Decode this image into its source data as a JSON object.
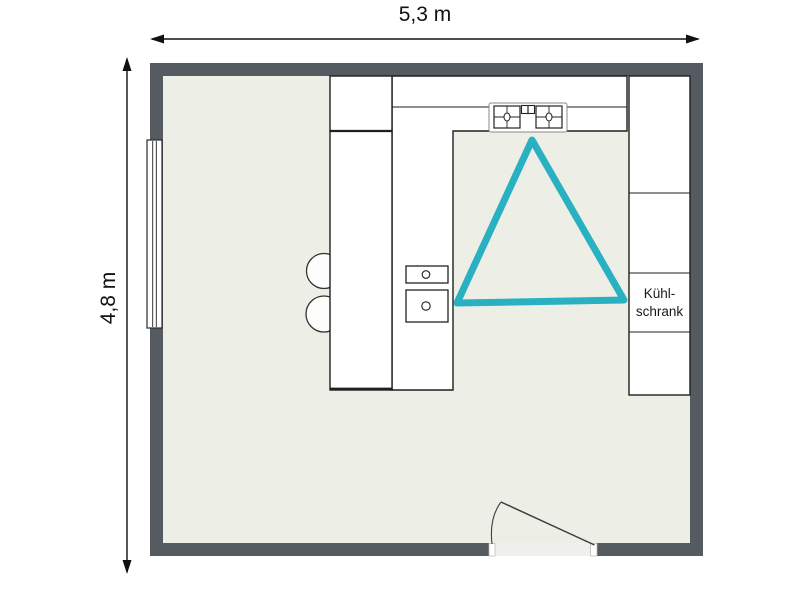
{
  "plan": {
    "type": "kitchen-floor-plan",
    "room_width_label": "5,3 m",
    "room_height_label": "4,8 m",
    "fridge_label_line1": "Kühl-",
    "fridge_label_line2": "schrank",
    "fixtures": [
      "window",
      "door",
      "stove",
      "sink",
      "bar-stools",
      "refrigerator",
      "cabinets",
      "work-triangle"
    ],
    "colors": {
      "wall": "#565b61",
      "floor": "#edefe6",
      "counter": "#ffffff",
      "outline": "#1f1f1f",
      "triangle": "#29b1c1",
      "dimension_text": "#111111"
    }
  }
}
